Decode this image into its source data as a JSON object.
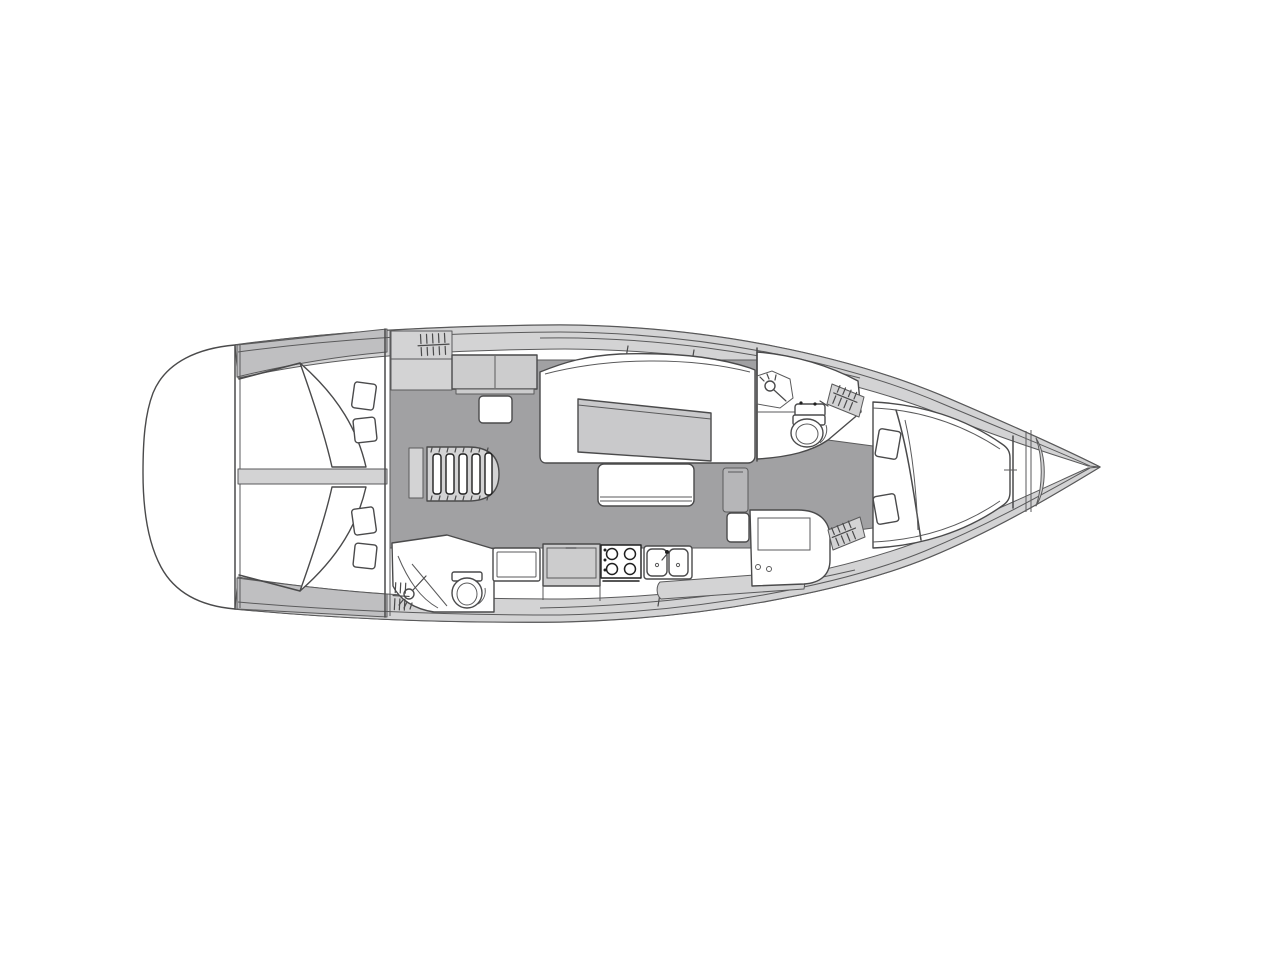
{
  "page": {
    "background": "#ffffff",
    "description": "sailing-yacht interior layout plan, top view, bow to the right, stern to the left"
  },
  "colors": {
    "outline": "#4a4a4b",
    "outline_dark": "#1f1f1f",
    "hull": "#ffffff",
    "deck_band": "#d3d3d4",
    "deck_band_dark": "#bfbfc1",
    "panel": "#cccccd",
    "sole": "#a1a1a3",
    "table": "#c9c9cb",
    "cabinet": "#b6b6b8",
    "white": "#ffffff"
  },
  "vessel": {
    "orientation": {
      "bow": "right",
      "stern": "left"
    },
    "areas": [
      {
        "id": "aft-cabin-port",
        "berths": 1,
        "pillows": 2
      },
      {
        "id": "aft-cabin-starboard",
        "berths": 1,
        "pillows": 2
      },
      {
        "id": "companionway",
        "features": [
          "ladder",
          "step-hatch",
          "cabinet",
          "seat"
        ]
      },
      {
        "id": "salon",
        "features": [
          "settee",
          "table",
          "bench",
          "side-cabinet"
        ]
      },
      {
        "id": "aft-head",
        "features": [
          "toilet",
          "shower",
          "hatched-locker"
        ]
      },
      {
        "id": "galley",
        "features": [
          "refrigerator",
          "counter",
          "stove",
          "double-sink"
        ]
      },
      {
        "id": "forward-head",
        "features": [
          "toilet",
          "washbasin",
          "shower"
        ]
      },
      {
        "id": "hanging-lockers",
        "count": 3
      },
      {
        "id": "forward-cabin",
        "berths": 1,
        "pillows": 2
      },
      {
        "id": "bow",
        "features": [
          "anchor-locker"
        ]
      }
    ]
  }
}
